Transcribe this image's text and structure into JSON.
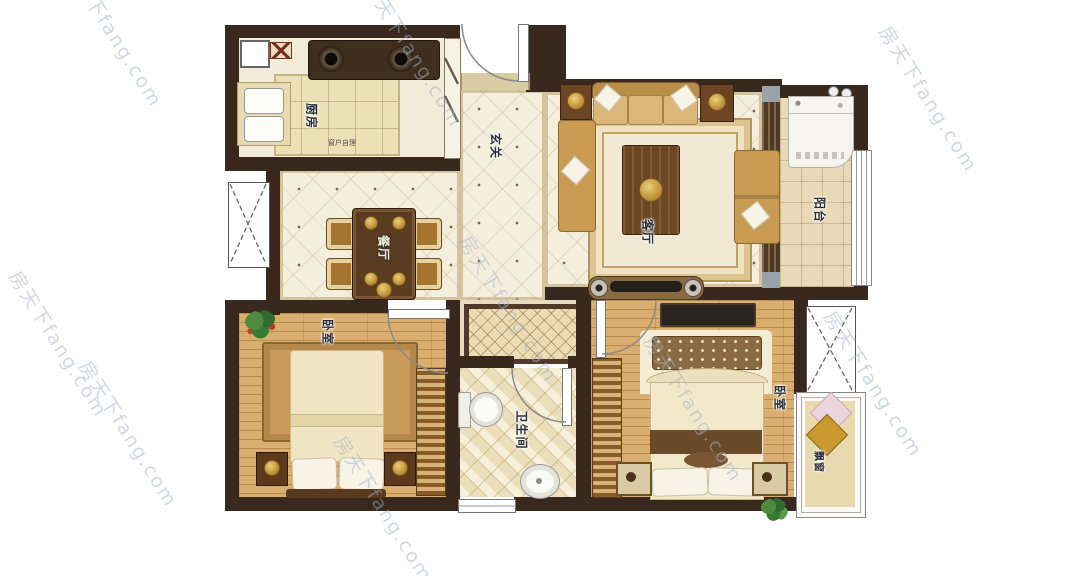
{
  "labels": {
    "kitchen": "厨房",
    "kitchen_note": "窗户自理",
    "entrance": "玄关",
    "living_room": "客厅",
    "balcony": "阳台",
    "dining_room": "餐厅",
    "bedroom_left": "卧室",
    "bedroom_right": "卧室",
    "bathroom": "卫生间",
    "bay_window": "飘窗"
  },
  "watermark": {
    "text": "房天下fang.com"
  },
  "colors": {
    "wall": "#38281d",
    "marble_floor": "#f4eedd",
    "wood_floor": "#d9ae6e",
    "kitchen_tile": "#ece0b8",
    "trim": "#c8b27e",
    "rug_border": "#50392a",
    "watermark": "#a2b2c8"
  }
}
